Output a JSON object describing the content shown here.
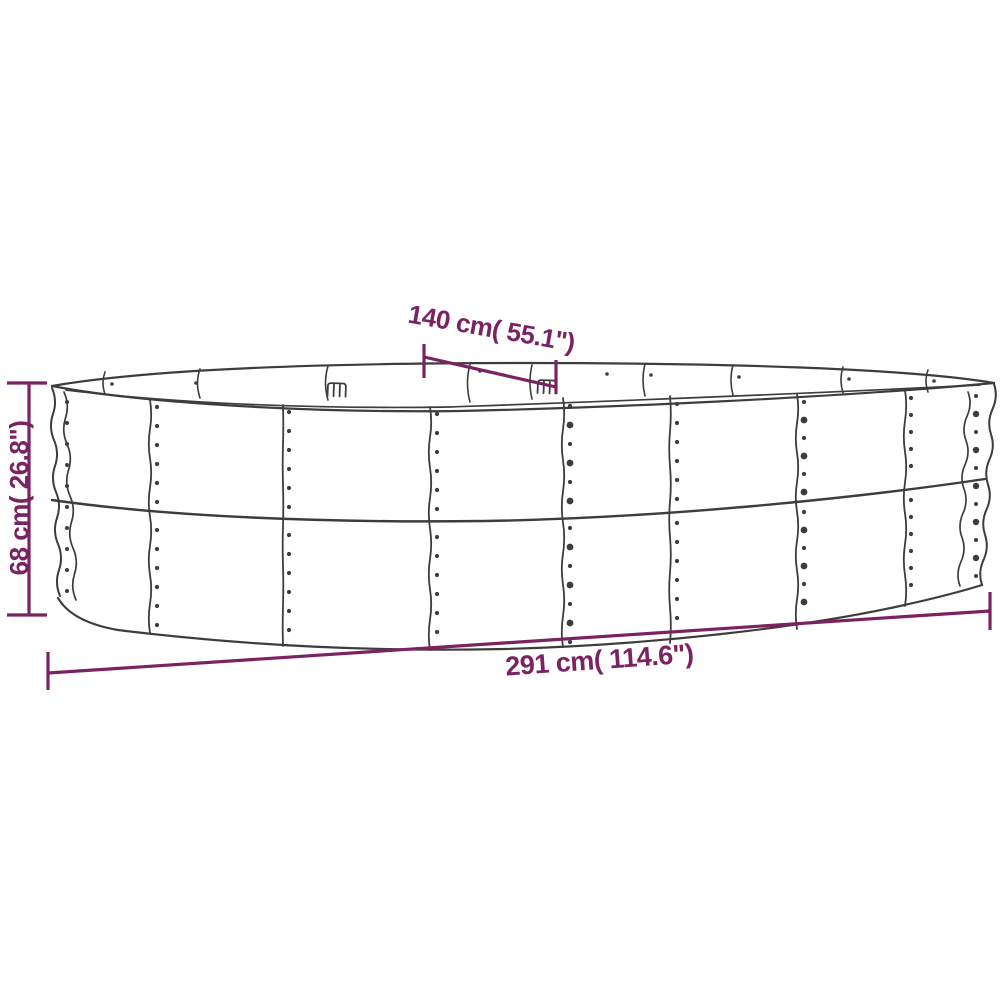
{
  "diagram": {
    "background": "#ffffff",
    "outline_color": "#3d3d3d",
    "dimension_color": "#7a2262",
    "subject": "oval raised garden bed line drawing",
    "dimensions": {
      "top_width": "140 cm( 55.1\")",
      "left_height": "68 cm( 26.8\")",
      "bottom_length": "291 cm( 114.6\")"
    }
  }
}
